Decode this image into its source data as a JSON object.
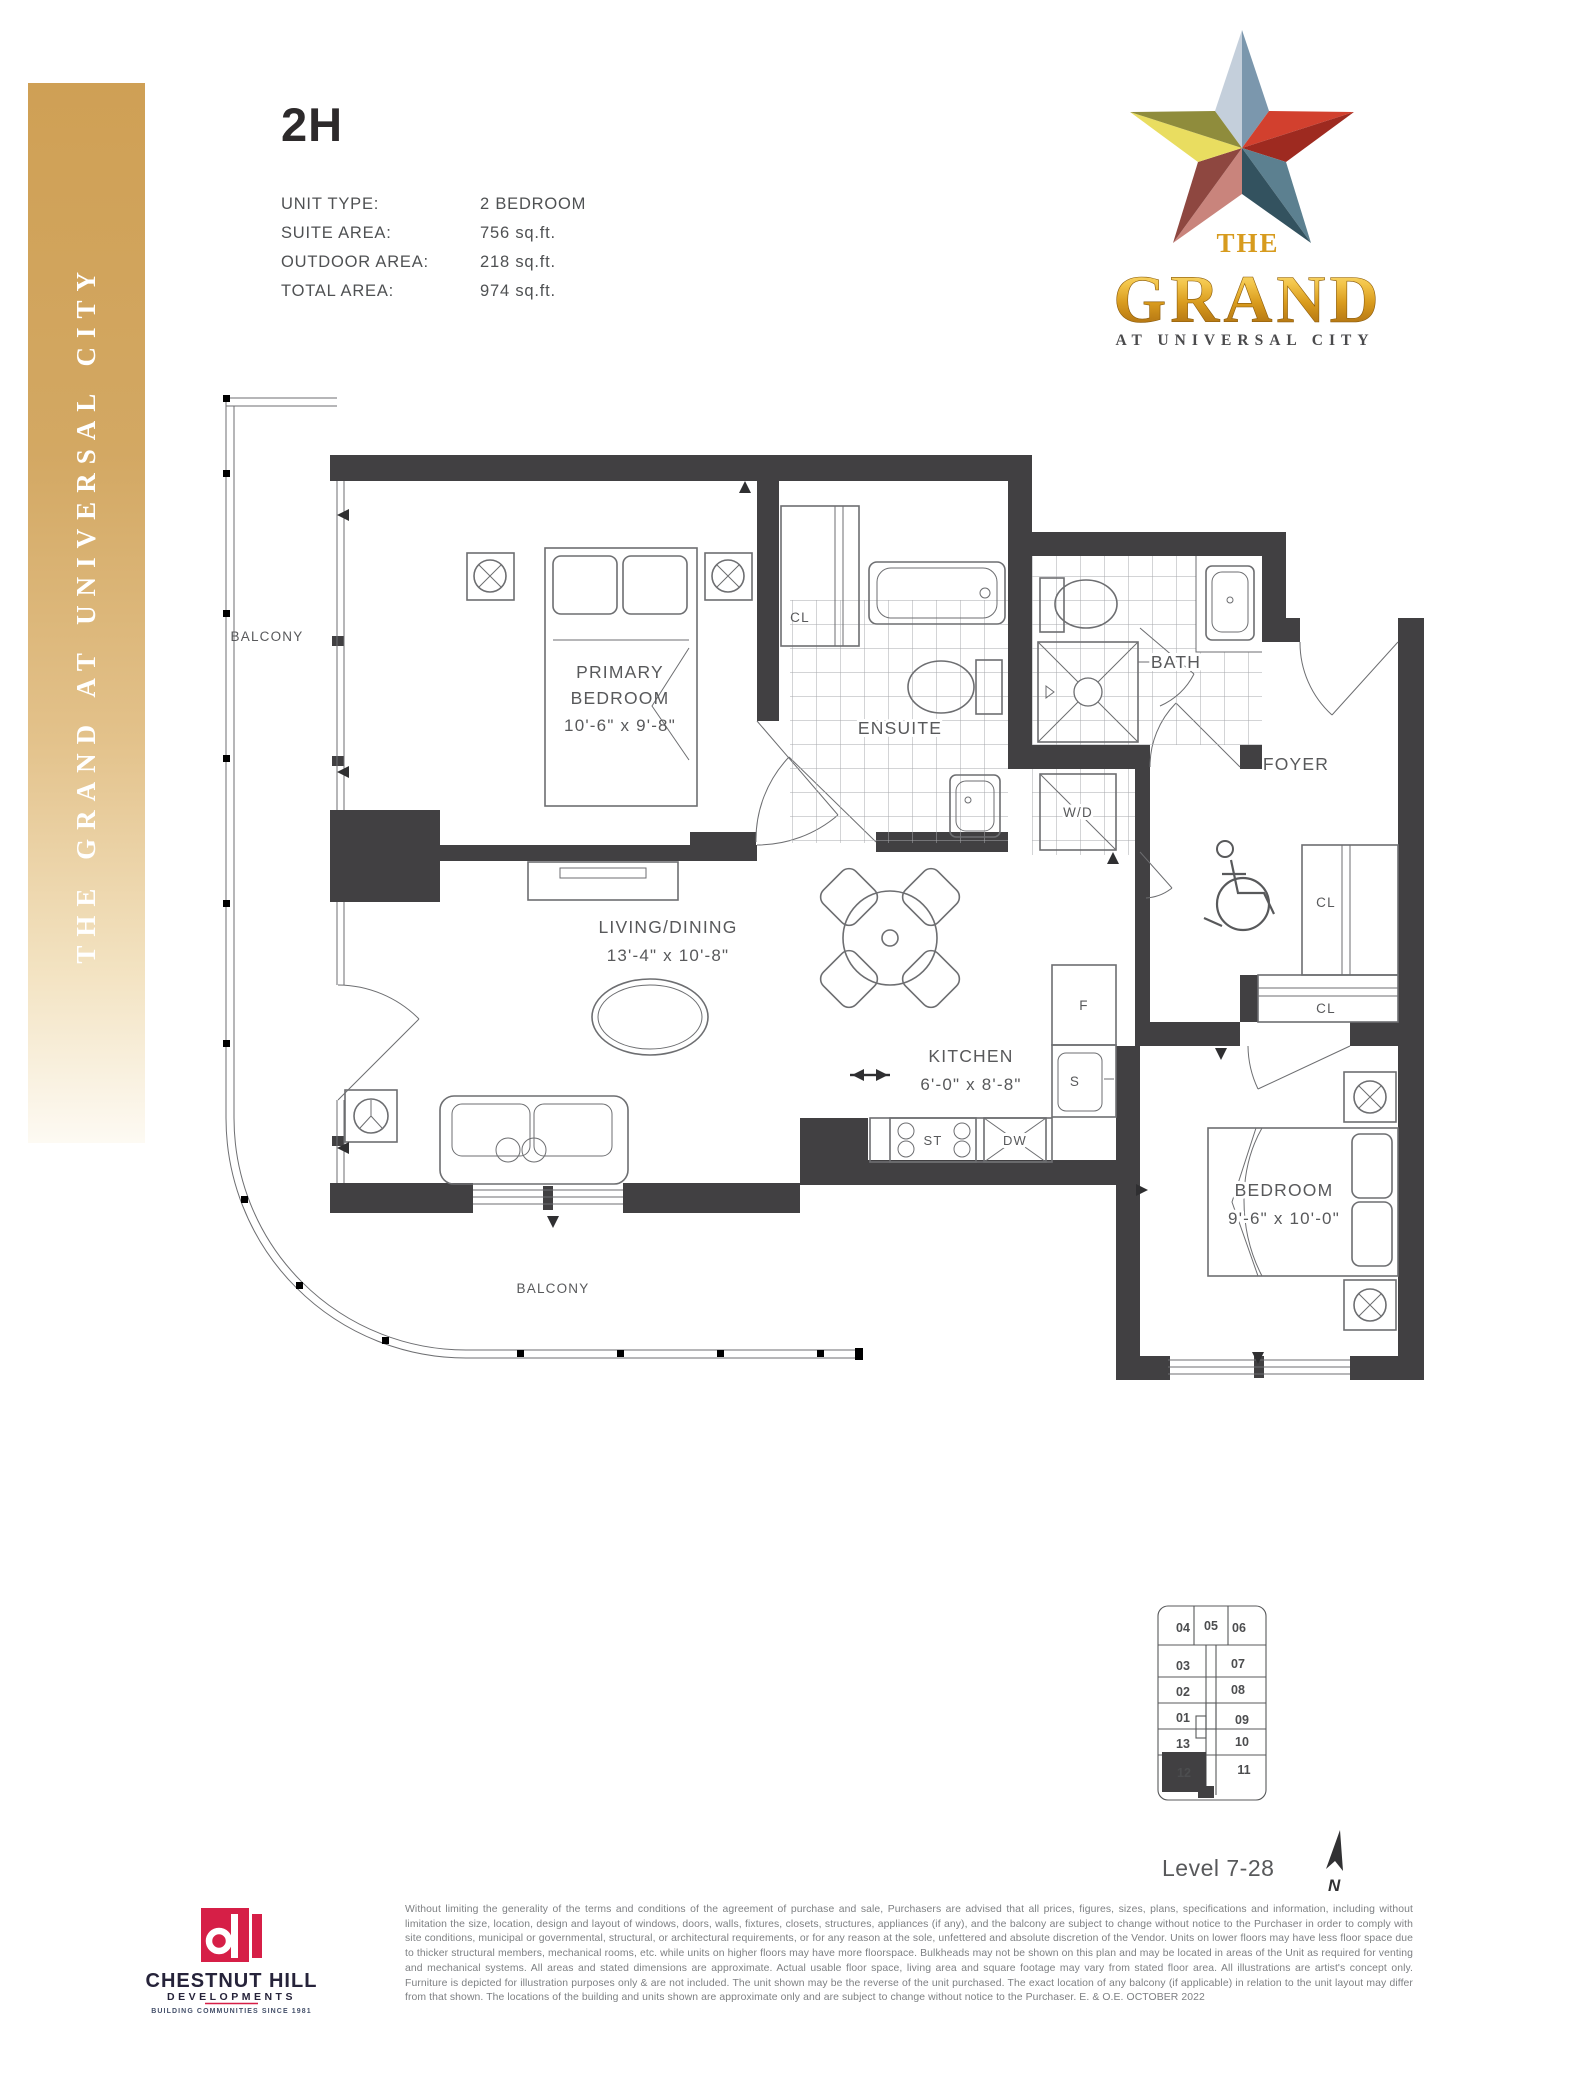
{
  "header": {
    "unit_code": "2H",
    "specs": [
      {
        "label": "UNIT TYPE:",
        "value": "2 BEDROOM"
      },
      {
        "label": "SUITE AREA:",
        "value": "756 sq.ft."
      },
      {
        "label": "OUTDOOR AREA:",
        "value": "218 sq.ft."
      },
      {
        "label": "TOTAL AREA:",
        "value": "974 sq.ft."
      }
    ]
  },
  "sidebar": {
    "text": "THE GRAND AT UNIVERSAL CITY"
  },
  "logo": {
    "the": "THE",
    "name": "GRAND",
    "tagline": "AT UNIVERSAL CITY",
    "star_colors": {
      "top_l": "#c4cfdb",
      "top_r": "#7b97ad",
      "right_u": "#d2402e",
      "right_l": "#9e2a20",
      "br_u": "#5c8090",
      "br_l": "#33525f",
      "bl_r": "#c9847c",
      "bl_l": "#8e4740",
      "left_d": "#e9dd60",
      "left_u": "#8f8c3c"
    }
  },
  "plan": {
    "balcony": "BALCONY",
    "primary_bedroom": {
      "l1": "PRIMARY",
      "l2": "BEDROOM",
      "dims": "10'-6\" x 9'-8\""
    },
    "living": {
      "l1": "LIVING/DINING",
      "dims": "13'-4\" x 10'-8\""
    },
    "kitchen": {
      "l1": "KITCHEN",
      "dims": "6'-0\" x 8'-8\""
    },
    "bedroom2": {
      "l1": "BEDROOM",
      "dims": "9'-6\" x 10'-0\""
    },
    "ensuite": "ENSUITE",
    "bath": "BATH",
    "foyer": "FOYER",
    "wd": "W/D",
    "cl": "CL",
    "f": "F",
    "s": "S",
    "st": "ST",
    "dw": "DW"
  },
  "keyplan": {
    "units": [
      "04",
      "05",
      "06",
      "03",
      "07",
      "02",
      "08",
      "01",
      "09",
      "13",
      "10",
      "12",
      "11"
    ],
    "highlighted": "12",
    "level": "Level 7-28",
    "north": "N"
  },
  "developer": {
    "name": "CHESTNUT HILL",
    "division": "DEVELOPMENTS",
    "tagline": "BUILDING COMMUNITIES SINCE 1981",
    "brand_red": "#d61f47"
  },
  "disclaimer": "Without limiting the generality of the terms and conditions of the agreement of purchase and sale, Purchasers are advised that all prices, figures, sizes, plans, specifications and information, including without limitation the size, location, design and layout of windows, doors, walls, fixtures, closets, structures, appliances (if any), and the balcony are subject to change without notice to the Purchaser in order to comply with site conditions, municipal or governmental, structural, or architectural requirements, or for any reason at the sole, unfettered and absolute discretion of the Vendor. Units on lower floors may have less floor space due to thicker structural members, mechanical rooms, etc. while units on higher floors may have more floorspace. Bulkheads may not be shown on this plan and may be located in areas of the Unit as required for venting and mechanical systems. All areas and stated dimensions are approximate. Actual usable floor space, living area and square footage may vary from stated floor area. All illustrations are artist's concept only. Furniture is depicted for illustration purposes only & are not included. The unit shown may be the reverse of the unit purchased. The exact location of any balcony (if applicable) in relation to the unit layout may differ from that shown. The locations of the building and units shown are approximate only and are subject to change without notice to the Purchaser. E. & O.E. OCTOBER 2022"
}
